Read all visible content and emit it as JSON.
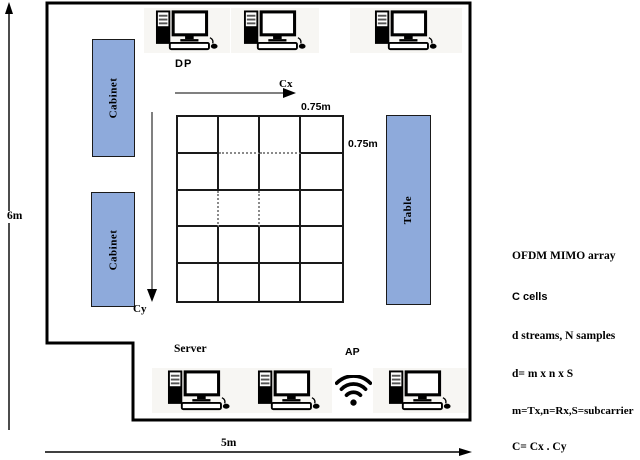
{
  "figure": {
    "dims": {
      "room_height": "6m",
      "room_width": "5m",
      "cell_width": "0.75m",
      "cell_height": "0.75m"
    },
    "labels": {
      "dp": "DP",
      "cx_axis": "Cx",
      "cy_axis": "Cy",
      "server": "Server",
      "access_point": "AP"
    },
    "furniture": {
      "cabinet_top": "Cabinet",
      "cabinet_bottom": "Cabinet",
      "table": "Table"
    }
  },
  "grid": {
    "rows": 5,
    "cols": 4,
    "dotted_bottom": [
      [
        0,
        1
      ],
      [
        0,
        2
      ]
    ],
    "dotted_right": [
      [
        2,
        0
      ],
      [
        2,
        1
      ]
    ]
  },
  "legend": {
    "lines": [
      "OFDM MIMO array",
      "C cells",
      "d streams, N samples",
      "d= m x n x S",
      "m=Tx,n=Rx,S=subcarrier",
      "C= Cx . Cy"
    ]
  },
  "icons": {
    "computer": "desktop-computer-icon",
    "wifi": "wifi-access-point-icon"
  },
  "colors": {
    "furniture": "#8EAADB",
    "wall": "#000000",
    "arrow_gray": "#808080"
  }
}
